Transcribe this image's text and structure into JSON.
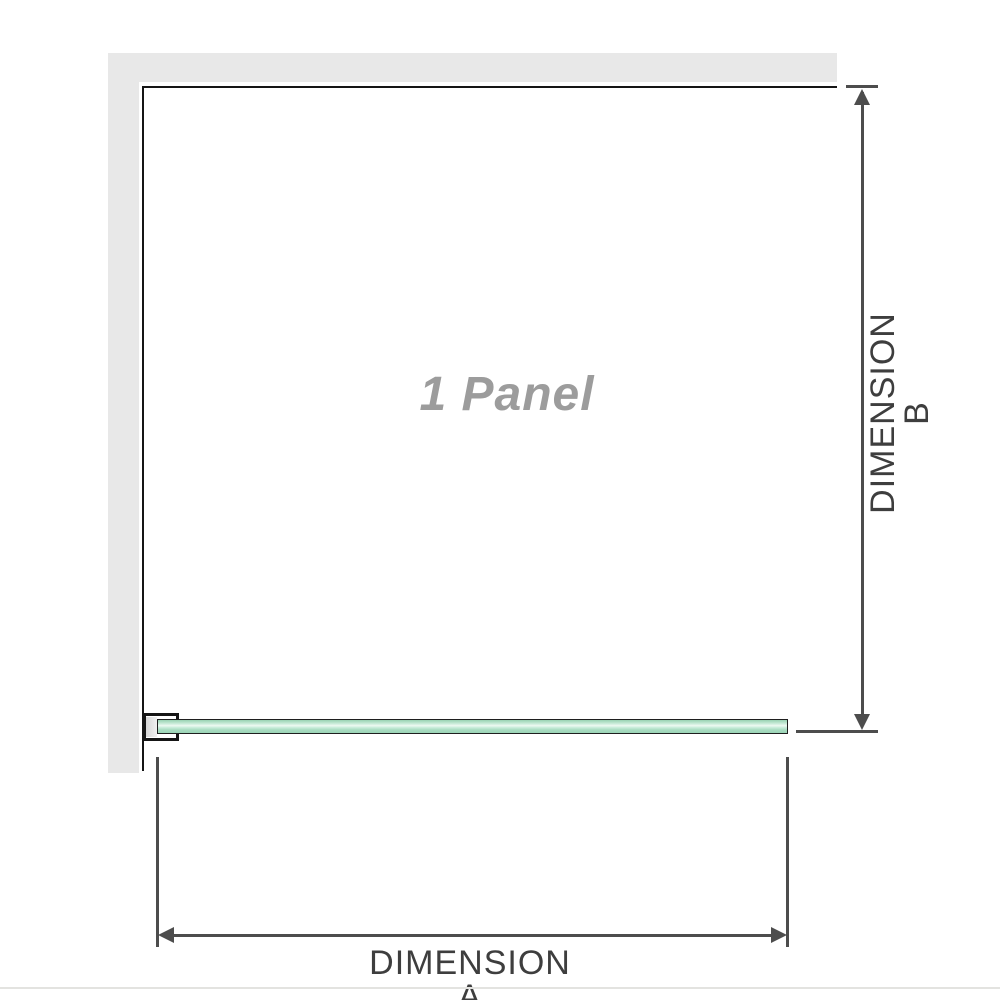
{
  "diagram": {
    "type": "product-dimension-diagram",
    "panel_label": "1 Panel",
    "dimension_a": {
      "label": "DIMENSION A",
      "orientation": "horizontal"
    },
    "dimension_b": {
      "label": "DIMENSION B",
      "orientation": "vertical"
    }
  },
  "icons": {
    "dimension_b_top": "arrow-up-icon",
    "dimension_b_bottom": "arrow-down-icon",
    "dimension_a_left": "arrow-left-icon",
    "dimension_a_right": "arrow-right-icon"
  },
  "colors": {
    "background": "#ffffff",
    "wall_gray": "#e8e8e8",
    "panel_outline": "#151515",
    "dimension_line": "#4d4d4d",
    "dimension_label_text": "#3e3e3e",
    "panel_label_text": "#9c9c9c",
    "glass_green": "#a9dcc1",
    "glass_highlight": "#eefaf2",
    "baseline_gray": "#e3e3e0"
  }
}
